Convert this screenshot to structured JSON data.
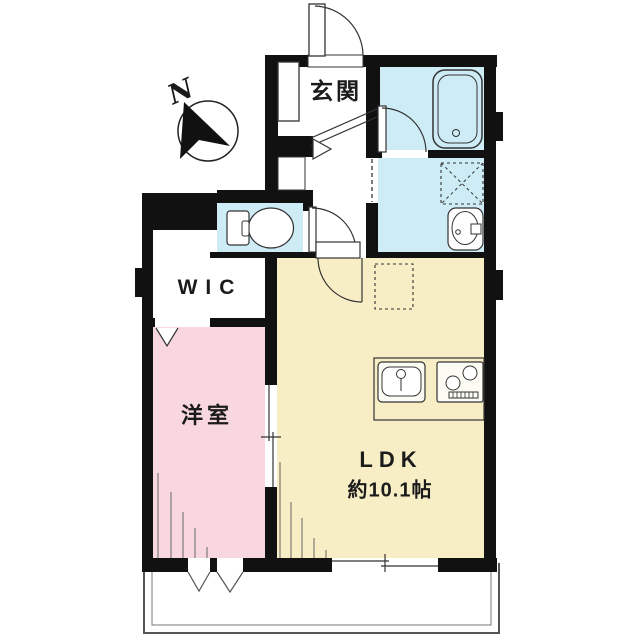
{
  "plan": {
    "compass_label": "N",
    "rooms": {
      "genkan": "玄関",
      "wic": "WIC",
      "western_room": "洋室",
      "ldk_name": "LDK",
      "ldk_size": "約10.1帖"
    },
    "colors": {
      "wall": "#111111",
      "wet_area": "#cdecf6",
      "bedroom": "#f8d8de",
      "living": "#f8eec6",
      "fixture_fill": "#ffffff",
      "panel_fill": "#fcfcf4",
      "line": "#333333"
    }
  }
}
